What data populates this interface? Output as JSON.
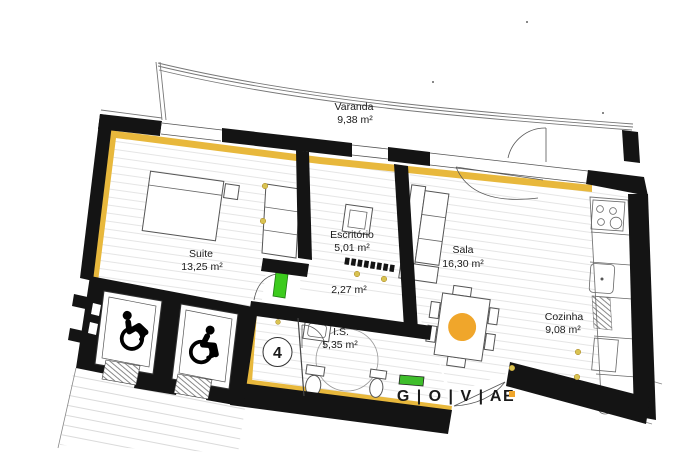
{
  "plan": {
    "unit": {
      "number": "4"
    },
    "rooms": {
      "varanda": {
        "name": "Varanda",
        "area": "9,38 m²"
      },
      "suite": {
        "name": "Suite",
        "area": "13,25 m²"
      },
      "escritorio": {
        "name": "Escritório",
        "area": "5,01 m²"
      },
      "hall": {
        "area": "2,27 m²"
      },
      "sala": {
        "name": "Sala",
        "area": "16,30 m²"
      },
      "cozinha": {
        "name": "Cozinha",
        "area": "9,08 m²"
      },
      "is": {
        "name": "I.S.",
        "area": "5,35 m²"
      }
    },
    "logo": {
      "text": "G | O | V | AE"
    },
    "icons": {
      "wheelchair": "♿"
    },
    "colors": {
      "wall": "#141414",
      "insulation_yellow": "#E8B83C",
      "accent_orange": "#F0A62B",
      "outlet_yellow": "#D9C352",
      "door_green": "#3CCB1D",
      "unit_blue": "#2A2AA0",
      "logo_red": "#CE3224",
      "logo_green": "#3FBE2B"
    }
  }
}
